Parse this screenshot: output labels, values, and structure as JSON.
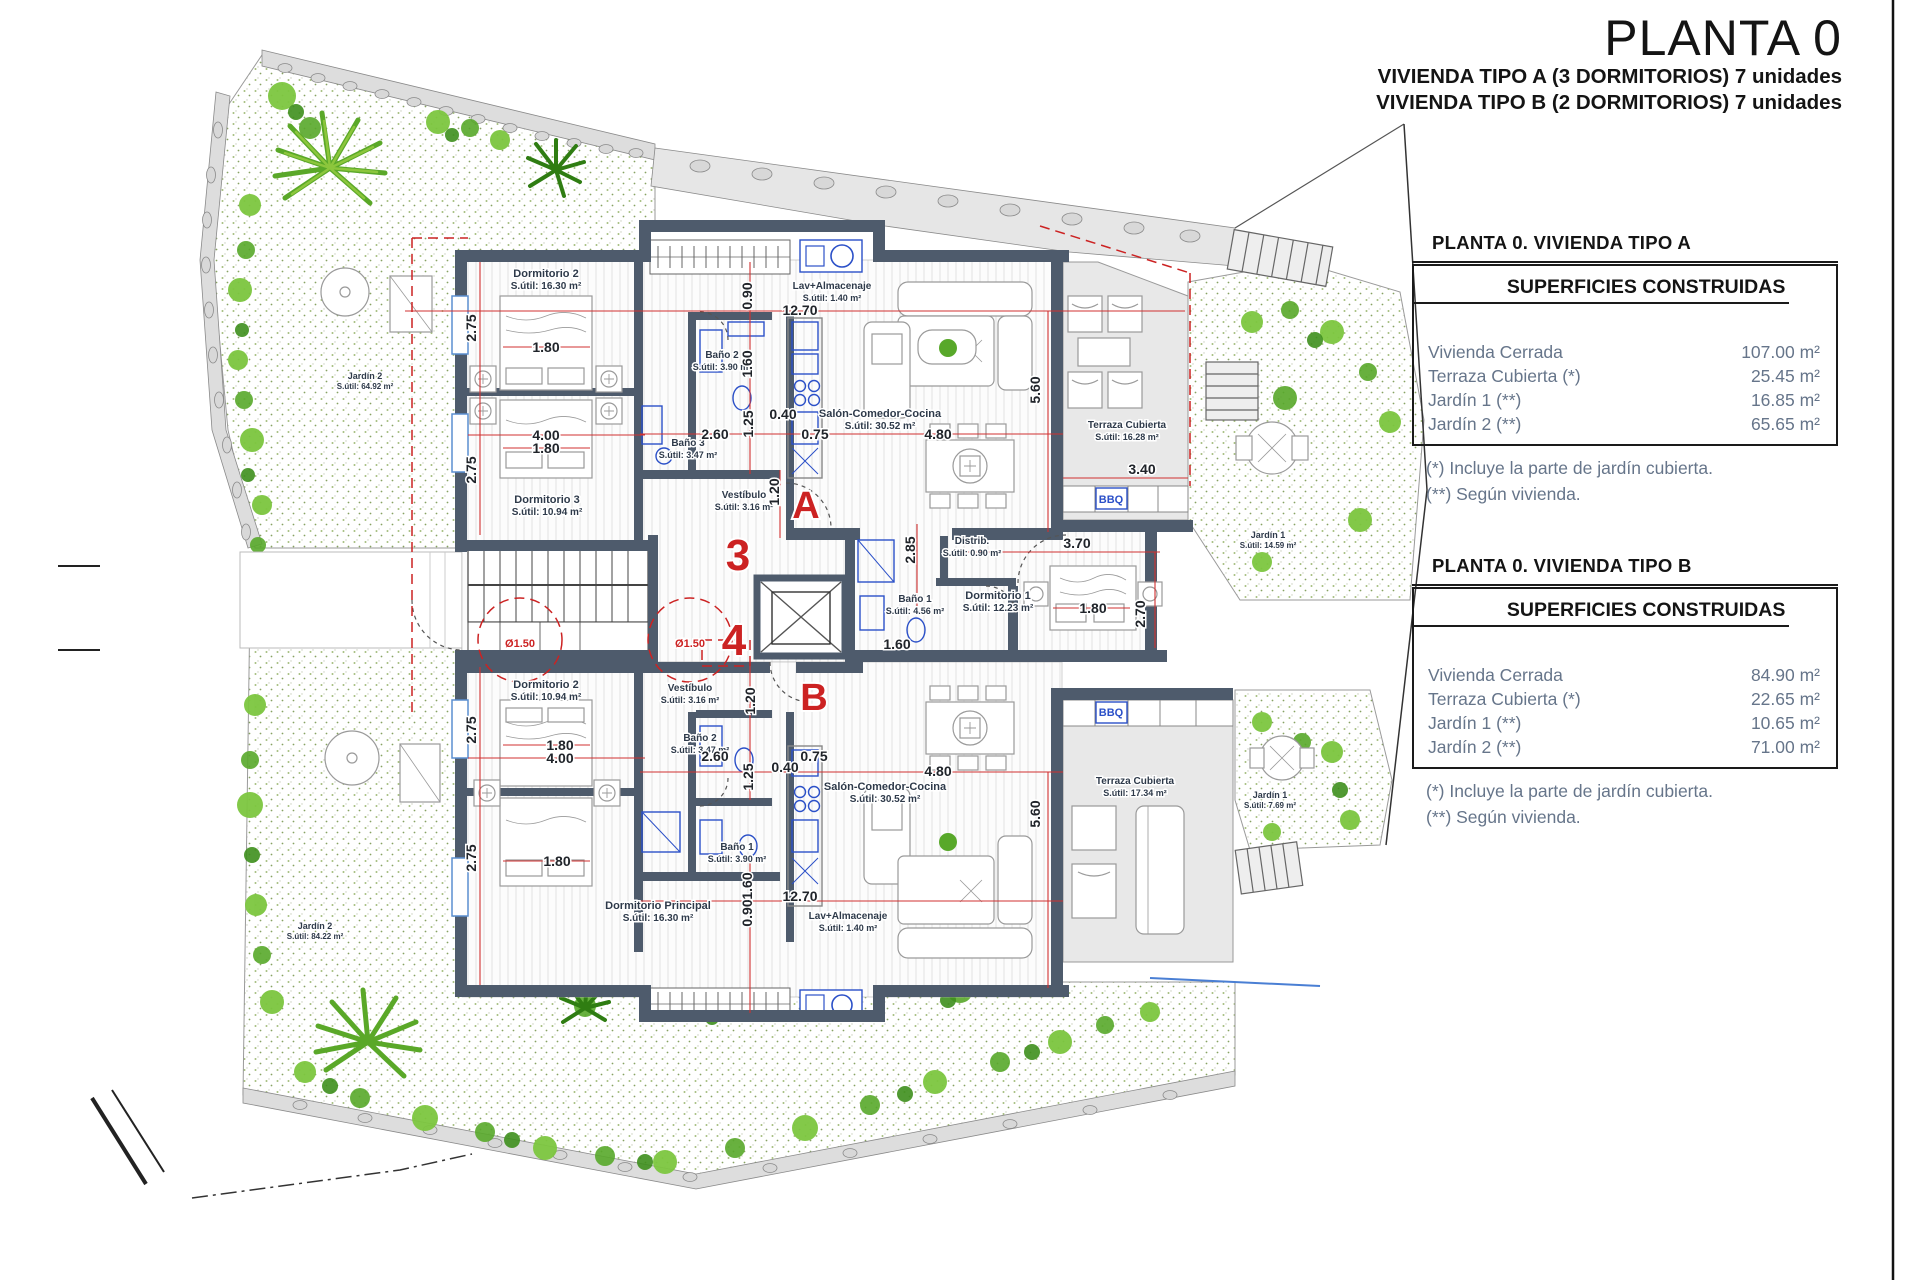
{
  "title": {
    "main": "PLANTA 0",
    "line1": "VIVIENDA TIPO A (3 DORMITORIOS) 7 unidades",
    "line2": "VIVIENDA TIPO B (2 DORMITORIOS) 7 unidades"
  },
  "panels": [
    {
      "heading": "PLANTA 0. VIVIENDA TIPO A",
      "box_title": "SUPERFICIES CONSTRUIDAS",
      "rows": [
        {
          "label": "Vivienda Cerrada",
          "value": "107.00 m²"
        },
        {
          "label": "Terraza Cubierta  (*)",
          "value": "25.45 m²"
        },
        {
          "label": "Jardín 1 (**)",
          "value": "16.85 m²"
        },
        {
          "label": "Jardín 2 (**)",
          "value": "65.65 m²"
        }
      ],
      "notes": [
        "(*)  Incluye la parte de jardín cubierta.",
        "(**) Según vivienda."
      ]
    },
    {
      "heading": "PLANTA 0. VIVIENDA TIPO B",
      "box_title": "SUPERFICIES CONSTRUIDAS",
      "rows": [
        {
          "label": "Vivienda Cerrada",
          "value": "84.90 m²"
        },
        {
          "label": "Terraza Cubierta (*)",
          "value": "22.65 m²"
        },
        {
          "label": "Jardín 1 (**)",
          "value": "10.65 m²"
        },
        {
          "label": "Jardín 2 (**)",
          "value": "71.00 m²"
        }
      ],
      "notes": [
        "(*) Incluye la parte de jardín cubierta.",
        "(**) Según vivienda."
      ]
    }
  ],
  "plan": {
    "colors": {
      "wall": "#4e5b6c",
      "red": "#cc2222",
      "fixture_blue": "#2b50c8",
      "terrace_gray": "#e8e8e8",
      "label": "#2e3a4a",
      "dimension": "#20242a",
      "garden_green": "#58a82a",
      "stone_gray": "#d8d8d8",
      "panel_text": "#66758a"
    },
    "rooms": [
      {
        "name": "Dormitorio 2",
        "area": "S.útil: 16.30 m²",
        "x": 546,
        "y": 277
      },
      {
        "name": "Dormitorio 3",
        "area": "S.útil: 10.94 m²",
        "x": 547,
        "y": 503
      },
      {
        "name": "Baño 3",
        "area": "S.útil: 3.47 m²",
        "x": 688,
        "y": 446,
        "s": 10
      },
      {
        "name": "Baño 2",
        "area": "S.útil: 3.90 m²",
        "x": 722,
        "y": 358,
        "s": 10
      },
      {
        "name": "Vestíbulo",
        "area": "S.útil: 3.16 m²",
        "x": 744,
        "y": 498,
        "s": 10
      },
      {
        "name": "Lav+Almacenaje",
        "area": "S.útil: 1.40 m²",
        "x": 832,
        "y": 289,
        "s": 10
      },
      {
        "name": "Salón-Comedor-Cocina",
        "area": "S.útil: 30.52 m²",
        "x": 880,
        "y": 417
      },
      {
        "name": "Terraza Cubierta",
        "area": "S.útil: 16.28 m²",
        "x": 1127,
        "y": 428,
        "s": 10
      },
      {
        "name": "Distrib.",
        "area": "S.útil: 0.90 m²",
        "x": 972,
        "y": 544,
        "s": 10
      },
      {
        "name": "Baño 1",
        "area": "S.útil: 4.56 m²",
        "x": 915,
        "y": 602,
        "s": 10
      },
      {
        "name": "Dormitorio 1",
        "area": "S.útil: 12.23 m²",
        "x": 998,
        "y": 599
      },
      {
        "name": "Jardín 1",
        "area": "S.útil: 14.59 m²",
        "x": 1268,
        "y": 538,
        "s": 9
      },
      {
        "name": "Jardín 2",
        "area": "S.útil: 64.92 m²",
        "x": 365,
        "y": 379,
        "s": 9
      },
      {
        "name": "Dormitorio 2",
        "area": "S.útil: 10.94 m²",
        "x": 546,
        "y": 688
      },
      {
        "name": "Vestíbulo",
        "area": "S.útil: 3.16 m²",
        "x": 690,
        "y": 691,
        "s": 10
      },
      {
        "name": "Baño 2",
        "area": "S.útil: 3.47 m²",
        "x": 700,
        "y": 741,
        "s": 10
      },
      {
        "name": "Baño 1",
        "area": "S.útil: 3.90 m²",
        "x": 737,
        "y": 850,
        "s": 10
      },
      {
        "name": "Dormitorio Principal",
        "area": "S.útil: 16.30 m²",
        "x": 658,
        "y": 909
      },
      {
        "name": "Lav+Almacenaje",
        "area": "S.útil: 1.40 m²",
        "x": 848,
        "y": 919,
        "s": 10
      },
      {
        "name": "Salón-Comedor-Cocina",
        "area": "S.útil: 30.52 m²",
        "x": 885,
        "y": 790
      },
      {
        "name": "Terraza Cubierta",
        "area": "S.útil: 17.34 m²",
        "x": 1135,
        "y": 784,
        "s": 10
      },
      {
        "name": "Jardín 1",
        "area": "S.útil: 7.69 m²",
        "x": 1270,
        "y": 798,
        "s": 9
      },
      {
        "name": "Jardín 2",
        "area": "S.útil: 84.22 m²",
        "x": 315,
        "y": 929,
        "s": 9
      }
    ],
    "dimensions": [
      {
        "t": "2.75",
        "x": 476,
        "y": 328,
        "rot": 1
      },
      {
        "t": "1.80",
        "x": 546,
        "y": 352
      },
      {
        "t": "4.00",
        "x": 546,
        "y": 440
      },
      {
        "t": "1.80",
        "x": 546,
        "y": 453
      },
      {
        "t": "2.75",
        "x": 476,
        "y": 470,
        "rot": 1
      },
      {
        "t": "2.60",
        "x": 715,
        "y": 439
      },
      {
        "t": "1.25",
        "x": 753,
        "y": 424,
        "rot": 1
      },
      {
        "t": "0.40",
        "x": 783,
        "y": 419
      },
      {
        "t": "0.75",
        "x": 815,
        "y": 439
      },
      {
        "t": "4.80",
        "x": 938,
        "y": 439
      },
      {
        "t": "12.70",
        "x": 800,
        "y": 315
      },
      {
        "t": "0.90",
        "x": 752,
        "y": 296,
        "rot": 1
      },
      {
        "t": "1.60",
        "x": 752,
        "y": 364,
        "rot": 1
      },
      {
        "t": "5.60",
        "x": 1040,
        "y": 390,
        "rot": 1
      },
      {
        "t": "3.40",
        "x": 1142,
        "y": 474
      },
      {
        "t": "1.20",
        "x": 779,
        "y": 492,
        "rot": 1
      },
      {
        "t": "2.85",
        "x": 915,
        "y": 550,
        "rot": 1
      },
      {
        "t": "1.60",
        "x": 897,
        "y": 649
      },
      {
        "t": "3.70",
        "x": 1077,
        "y": 548
      },
      {
        "t": "1.80",
        "x": 1093,
        "y": 613
      },
      {
        "t": "2.70",
        "x": 1145,
        "y": 614,
        "rot": 1
      },
      {
        "t": "2.75",
        "x": 476,
        "y": 730,
        "rot": 1
      },
      {
        "t": "1.80",
        "x": 560,
        "y": 750
      },
      {
        "t": "4.00",
        "x": 560,
        "y": 763
      },
      {
        "t": "2.75",
        "x": 476,
        "y": 858,
        "rot": 1
      },
      {
        "t": "1.80",
        "x": 557,
        "y": 866
      },
      {
        "t": "1.20",
        "x": 755,
        "y": 701,
        "rot": 1
      },
      {
        "t": "2.60",
        "x": 715,
        "y": 761
      },
      {
        "t": "1.25",
        "x": 753,
        "y": 777,
        "rot": 1
      },
      {
        "t": "0.40",
        "x": 785,
        "y": 772
      },
      {
        "t": "0.75",
        "x": 814,
        "y": 761
      },
      {
        "t": "4.80",
        "x": 938,
        "y": 776
      },
      {
        "t": "5.60",
        "x": 1040,
        "y": 814,
        "rot": 1
      },
      {
        "t": "12.70",
        "x": 800,
        "y": 901
      },
      {
        "t": "0.90",
        "x": 752,
        "y": 913,
        "rot": 1
      },
      {
        "t": "1.60",
        "x": 752,
        "y": 886,
        "rot": 1
      },
      {
        "t": "Ø1.50",
        "x": 520,
        "y": 647,
        "s": 11,
        "c": "#cc2222"
      },
      {
        "t": "Ø1.50",
        "x": 690,
        "y": 647,
        "s": 11,
        "c": "#cc2222"
      }
    ],
    "markers": [
      {
        "t": "A",
        "x": 806,
        "y": 518,
        "s": 38
      },
      {
        "t": "B",
        "x": 814,
        "y": 710,
        "s": 38
      },
      {
        "t": "3",
        "x": 738,
        "y": 570,
        "s": 44
      },
      {
        "t": "4",
        "x": 734,
        "y": 655,
        "s": 44
      }
    ],
    "features": [
      {
        "t": "BBQ",
        "x": 1111,
        "y": 503
      },
      {
        "t": "BBQ",
        "x": 1111,
        "y": 716
      }
    ]
  }
}
